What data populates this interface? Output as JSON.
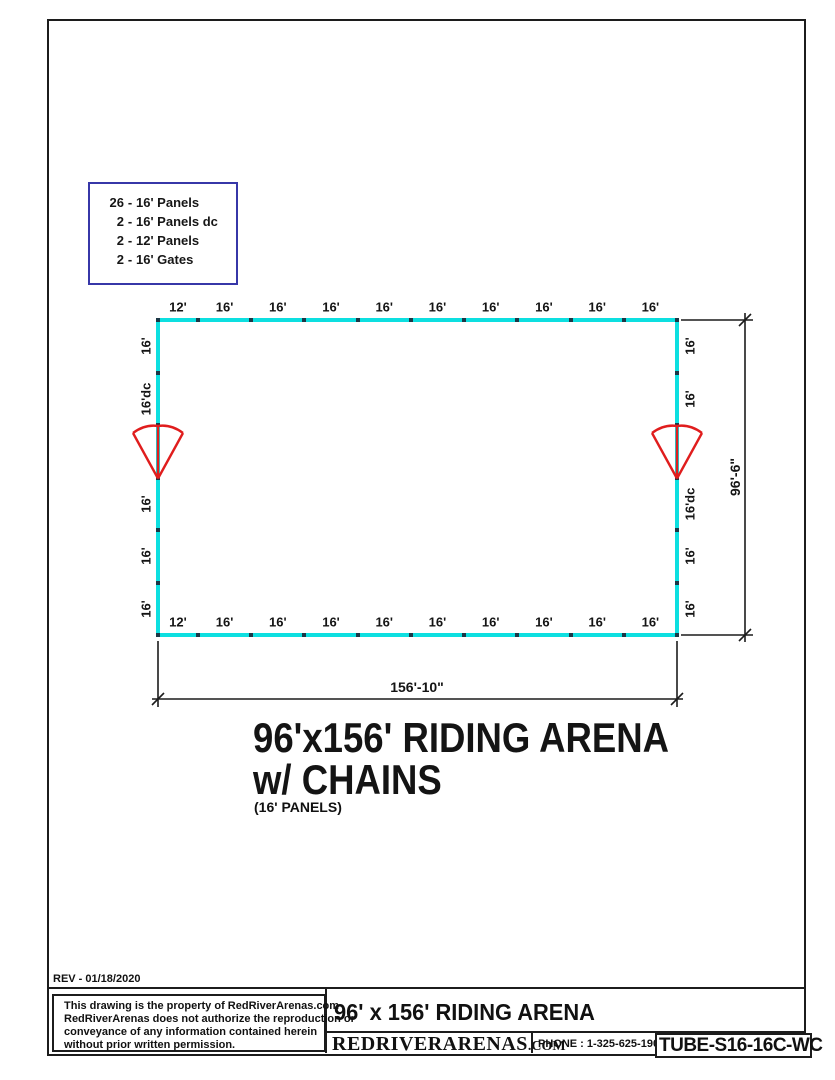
{
  "panel_list": {
    "separator": "-",
    "items": [
      {
        "qty": "26",
        "name": "16' Panels"
      },
      {
        "qty": "2",
        "name": "16' Panels dc"
      },
      {
        "qty": "2",
        "name": "12' Panels"
      },
      {
        "qty": "2",
        "name": "16' Gates"
      }
    ]
  },
  "arena": {
    "top_labels": [
      "12'",
      "16'",
      "16'",
      "16'",
      "16'",
      "16'",
      "16'",
      "16'",
      "16'",
      "16'"
    ],
    "bottom_labels": [
      "12'",
      "16'",
      "16'",
      "16'",
      "16'",
      "16'",
      "16'",
      "16'",
      "16'",
      "16'"
    ],
    "left_labels": [
      "16'",
      "16'dc",
      "",
      "16'",
      "16'",
      "16'"
    ],
    "right_labels": [
      "16'",
      "16'",
      "",
      "16'dc",
      "16'",
      "16'"
    ],
    "gates": [
      {
        "side": "left",
        "segment": 2
      },
      {
        "side": "right",
        "segment": 2
      }
    ]
  },
  "dims": {
    "width": "156'-10\"",
    "height": "96'-6\""
  },
  "title": {
    "line1": "96'x156' RIDING ARENA",
    "line2": "w/ CHAINS",
    "note": "(16' PANELS)"
  },
  "rev": "REV - 01/18/2020",
  "legal": [
    "This drawing is the property of RedRiverArenas.com",
    "RedRiverArenas does not authorize the reproduction or",
    "conveyance of any information contained herein",
    "without prior written permission."
  ],
  "title_block": {
    "drawing_title": "96' x 156' RIDING ARENA",
    "brand": "REDRIVERARENAS",
    "brand_tld": ".COM",
    "phone": "PHONE : 1-325-625-1900",
    "part_number": "TUBE-S16-16C-WC"
  },
  "colors": {
    "arena_line": "#0ddfe0",
    "gate": "#e01d1d",
    "panel_box_border": "#3737a8"
  }
}
